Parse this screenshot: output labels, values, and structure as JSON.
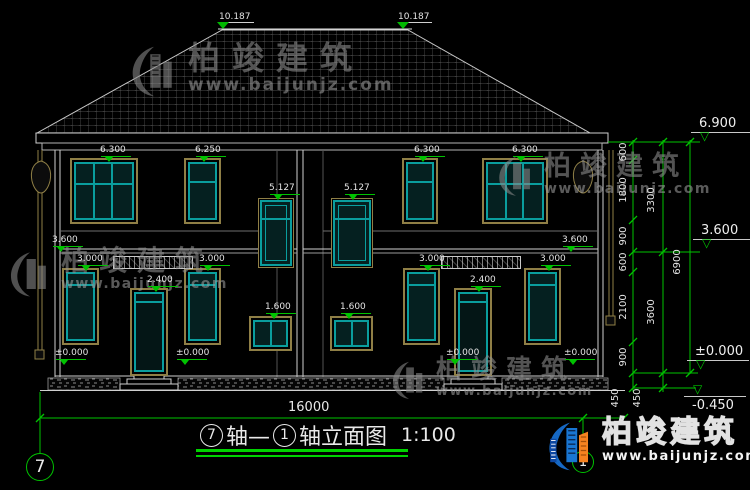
{
  "watermark": {
    "brand": "柏竣建筑",
    "url": "www.baijunjz.com"
  },
  "logo": {
    "brand": "柏竣建筑",
    "url": "www.baijunjz.com"
  },
  "title": {
    "bubble_left": "7",
    "seg1": "轴—",
    "bubble_right": "1",
    "seg2": "轴立面图",
    "scale": "1:100"
  },
  "axis_bubbles": {
    "left": "7",
    "right": "1"
  },
  "bottom_dimension": {
    "total": "16000"
  },
  "facade_labels": [
    {
      "t": "10.187",
      "x": 219,
      "y": 13,
      "cls": "nomark"
    },
    {
      "t": "10.187",
      "x": 398,
      "y": 13,
      "cls": "nomark"
    },
    {
      "t": "6.300",
      "x": 100,
      "y": 146
    },
    {
      "t": "6.250",
      "x": 195,
      "y": 146
    },
    {
      "t": "6.300",
      "x": 414,
      "y": 146
    },
    {
      "t": "6.300",
      "x": 512,
      "y": 146
    },
    {
      "t": "5.127",
      "x": 269,
      "y": 184
    },
    {
      "t": "5.127",
      "x": 344,
      "y": 184
    },
    {
      "t": "3.600",
      "x": 52,
      "y": 236
    },
    {
      "t": "3.600",
      "x": 562,
      "y": 236
    },
    {
      "t": "3.000",
      "x": 77,
      "y": 255
    },
    {
      "t": "3.000",
      "x": 199,
      "y": 255
    },
    {
      "t": "3.000",
      "x": 419,
      "y": 255
    },
    {
      "t": "3.000",
      "x": 540,
      "y": 255
    },
    {
      "t": "2.400",
      "x": 147,
      "y": 276
    },
    {
      "t": "2.400",
      "x": 470,
      "y": 276
    },
    {
      "t": "1.600",
      "x": 265,
      "y": 303
    },
    {
      "t": "1.600",
      "x": 340,
      "y": 303
    },
    {
      "t": "±0.000",
      "x": 55,
      "y": 349
    },
    {
      "t": "±0.000",
      "x": 176,
      "y": 349
    },
    {
      "t": "±0.000",
      "x": 446,
      "y": 349
    },
    {
      "t": "±0.000",
      "x": 564,
      "y": 349
    }
  ],
  "right_levels": [
    {
      "t": "6.900",
      "x": 699,
      "y": 117
    },
    {
      "t": "3.600",
      "x": 701,
      "y": 224
    },
    {
      "t": "±0.000",
      "x": 695,
      "y": 345
    },
    {
      "t": "-0.450",
      "x": 692,
      "y": 399,
      "cls": "flip"
    }
  ],
  "chain_labels": [
    {
      "t": "600",
      "x": 624,
      "y": 152
    },
    {
      "t": "1800",
      "x": 624,
      "y": 190
    },
    {
      "t": "900",
      "x": 624,
      "y": 236
    },
    {
      "t": "600",
      "x": 624,
      "y": 262
    },
    {
      "t": "2100",
      "x": 624,
      "y": 307
    },
    {
      "t": "900",
      "x": 624,
      "y": 357
    },
    {
      "t": "450",
      "x": 616,
      "y": 398
    },
    {
      "t": "3300",
      "x": 652,
      "y": 200
    },
    {
      "t": "3600",
      "x": 652,
      "y": 312
    },
    {
      "t": "450",
      "x": 638,
      "y": 398
    },
    {
      "t": "6900",
      "x": 678,
      "y": 262
    }
  ]
}
